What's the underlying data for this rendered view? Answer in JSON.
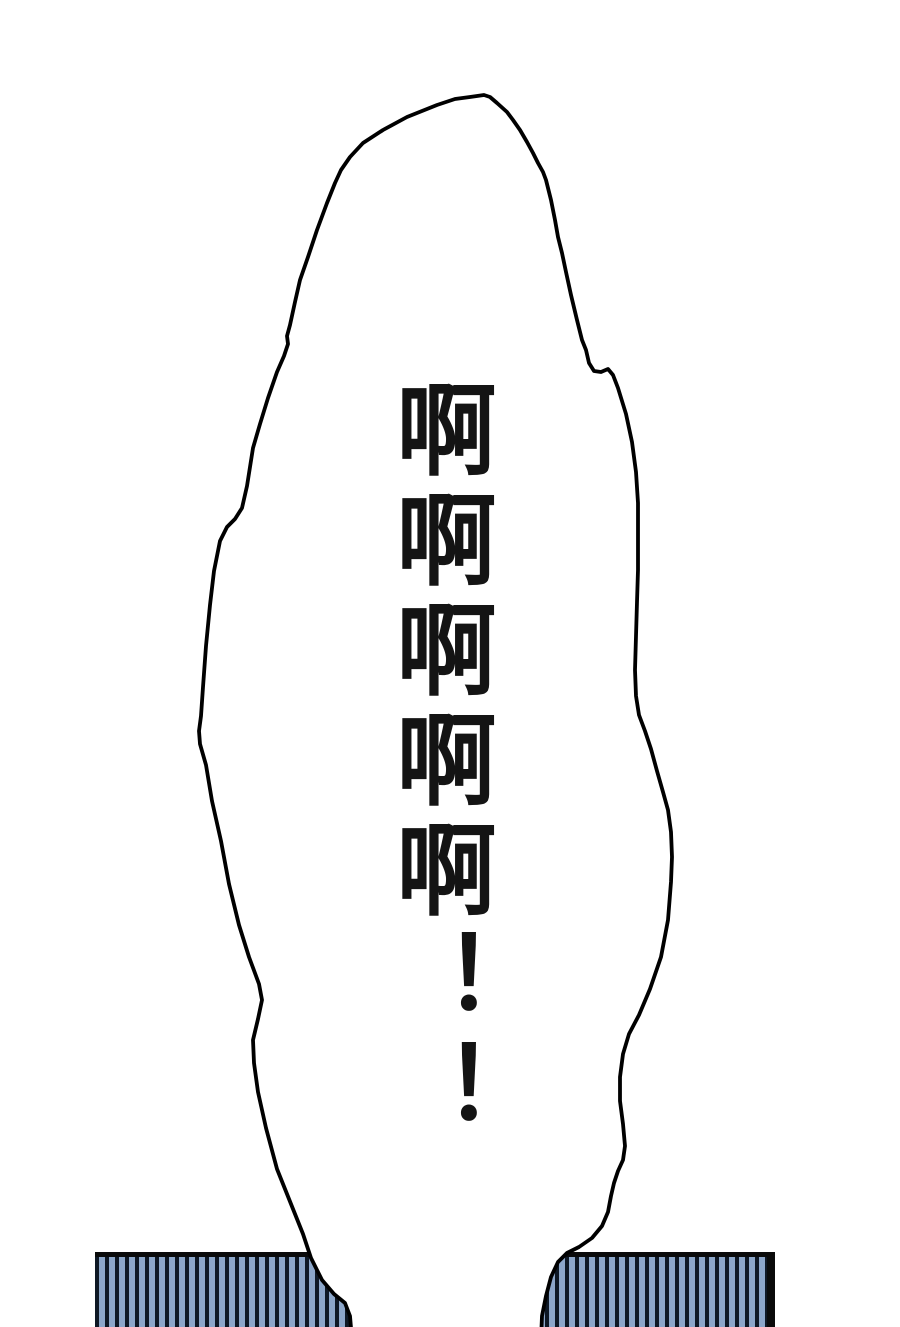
{
  "panel": {
    "type_label": "manga-panel",
    "speech_text": "啊啊啊啊啊！！",
    "colors": {
      "background": "#ffffff",
      "line": "#000000",
      "bubble_fill": "#ffffff",
      "wall_blue": "#8ca6c9",
      "wall_stripe_dark": "#0e1825",
      "wall_border": "#0a0a0a",
      "text_color": "#141414"
    }
  }
}
